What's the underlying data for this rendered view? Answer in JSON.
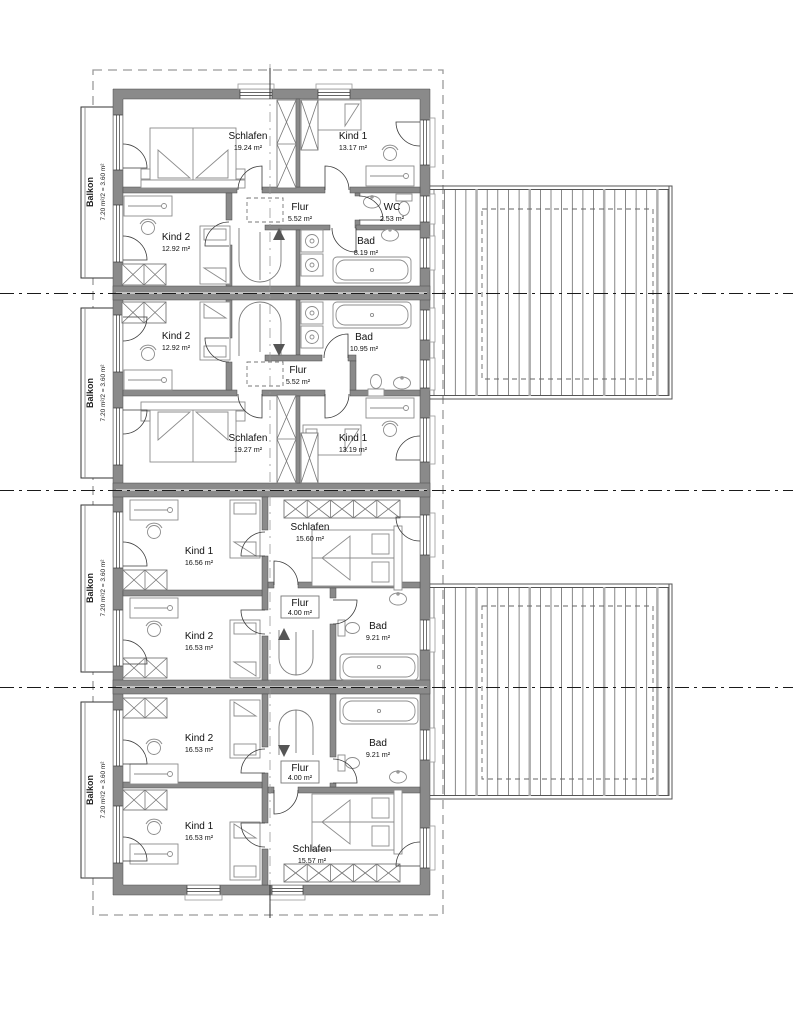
{
  "plan": {
    "units": [
      {
        "rooms": [
          {
            "label": "Schlafen",
            "area": "19.24 m²"
          },
          {
            "label": "Kind 1",
            "area": "13.17 m²"
          },
          {
            "label": "Flur",
            "area": "5.52 m²"
          },
          {
            "label": "WC",
            "area": "2.53 m²"
          },
          {
            "label": "Kind 2",
            "area": "12.92 m²"
          },
          {
            "label": "Bad",
            "area": "8.19 m²"
          }
        ]
      },
      {
        "rooms": [
          {
            "label": "Kind 2",
            "area": "12.92 m²"
          },
          {
            "label": "Bad",
            "area": "10.95 m²"
          },
          {
            "label": "Flur",
            "area": "5.52 m²"
          },
          {
            "label": "Schlafen",
            "area": "19.27 m²"
          },
          {
            "label": "Kind 1",
            "area": "13.19 m²"
          }
        ]
      },
      {
        "rooms": [
          {
            "label": "Kind 1",
            "area": "16.56 m²"
          },
          {
            "label": "Schlafen",
            "area": "15.60 m²"
          },
          {
            "label": "Flur",
            "area": "4.00 m²"
          },
          {
            "label": "Kind 2",
            "area": "16.53 m²"
          },
          {
            "label": "Bad",
            "area": "9.21 m²"
          }
        ]
      },
      {
        "rooms": [
          {
            "label": "Kind 2",
            "area": "16.53 m²"
          },
          {
            "label": "Bad",
            "area": "9.21 m²"
          },
          {
            "label": "Flur",
            "area": "4.00 m²"
          },
          {
            "label": "Kind 1",
            "area": "16.53 m²"
          },
          {
            "label": "Schlafen",
            "area": "15.57 m²"
          }
        ]
      }
    ],
    "balconies": [
      {
        "label": "Balkon",
        "area": "7.20 m²/2 = 3.60 m²"
      },
      {
        "label": "Balkon",
        "area": "7.20 m²/2 = 3.60 m²"
      },
      {
        "label": "Balkon",
        "area": "7.20 m²/2 = 3.60 m²"
      },
      {
        "label": "Balkon",
        "area": "7.20 m²/2 = 3.60 m²"
      }
    ]
  }
}
